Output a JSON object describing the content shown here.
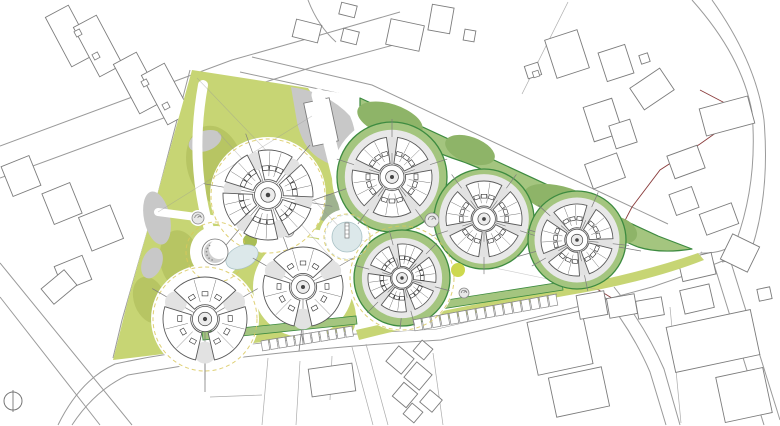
{
  "colors": {
    "bg": "#ffffff",
    "road": "#9a9a9a",
    "parcel": "#ababab",
    "ctx": "#7c7c7c",
    "red": "#8a3c3c",
    "olive": "#c7d574",
    "olive_dark": "#b7c563",
    "field": "#a4c57f",
    "field_dark": "#8eb468",
    "green_stroke": "#3d8b40",
    "grey": "#c8c8c8",
    "grey_green": "#9fb28f",
    "pond": "#dce8ea",
    "pond_stroke": "#a8c1c5",
    "yellow": "#d9c85c",
    "tree_fill": "#e2e2e2",
    "plaza_grey": "#e8e8e8",
    "tree_green": "#a8bd55",
    "tree_yellow": "#cdd94e",
    "bldg_stroke": "#5a5a5a"
  },
  "viewport": {
    "w": 780,
    "h": 426
  },
  "map": {
    "roads": [
      "M0,146 L232,60 L310,38 L400,12",
      "M0,178 L240,90 L316,66 L412,40",
      "M308,0 Q318,26 336,42",
      "M252,57 L372,85 L668,224",
      "M240,72 L360,98 L658,236",
      "M692,0 Q742,56 752,112 Q758,182 736,242 Q724,254 700,253",
      "M712,0 Q756,62 764,120 Q770,192 752,248 Q744,258 722,262",
      "M58,425 Q80,380 115,364 Q165,353 210,349 Q330,334 436,329 Q560,300 645,275 Q676,262 702,252",
      "M72,425 Q95,390 128,375 L218,360 Q335,346 441,340 Q565,311 652,287 Q700,271 744,252",
      "M712,258 L764,425",
      "M728,253 L780,420",
      "M600,291 Q632,330 650,372 L666,425",
      "M614,287 Q646,327 664,369 L680,425",
      "M0,263 L132,425",
      "M0,297 L100,425",
      "M190,70 L155,205 L122,320 L113,358",
      "M196,72 L160,206 L128,318"
    ],
    "parcel_lines": [
      "M268,358 L262,425",
      "M300,361 L296,425",
      "M332,356 L330,400",
      "M210,397 L262,395",
      "M568,2 L522,94",
      "M670,307 L681,423",
      "M352,347 L373,425",
      "M366,344 L388,425",
      "M433,353 L443,425"
    ],
    "red_boundary": [
      "M700,90 L744,113 L700,144 L660,170 L632,207 L608,253 L597,289",
      "M597,289 L643,317"
    ],
    "context_buildings": [
      [
        57,
        8,
        26,
        56,
        -28
      ],
      [
        85,
        18,
        26,
        56,
        -28
      ],
      [
        125,
        55,
        26,
        56,
        -28
      ],
      [
        153,
        66,
        26,
        56,
        -28
      ],
      [
        6,
        160,
        30,
        32,
        -22
      ],
      [
        47,
        187,
        30,
        33,
        -22
      ],
      [
        84,
        210,
        34,
        36,
        -22
      ],
      [
        58,
        260,
        30,
        26,
        -22
      ],
      [
        44,
        277,
        30,
        20,
        -40
      ],
      [
        294,
        22,
        26,
        18,
        14
      ],
      [
        340,
        4,
        16,
        12,
        14
      ],
      [
        342,
        30,
        16,
        13,
        14
      ],
      [
        388,
        22,
        34,
        26,
        12
      ],
      [
        430,
        6,
        22,
        26,
        10
      ],
      [
        464,
        30,
        11,
        11,
        10
      ],
      [
        550,
        34,
        34,
        40,
        -18
      ],
      [
        526,
        64,
        14,
        13,
        -18
      ],
      [
        602,
        48,
        28,
        30,
        -18
      ],
      [
        640,
        54,
        9,
        9,
        -18
      ],
      [
        634,
        76,
        36,
        26,
        -34
      ],
      [
        702,
        102,
        50,
        28,
        -15
      ],
      [
        588,
        102,
        30,
        36,
        -18
      ],
      [
        612,
        122,
        22,
        24,
        -18
      ],
      [
        588,
        158,
        34,
        26,
        -20
      ],
      [
        670,
        150,
        32,
        24,
        -20
      ],
      [
        672,
        190,
        24,
        22,
        -20
      ],
      [
        702,
        208,
        34,
        22,
        -20
      ],
      [
        726,
        238,
        28,
        30,
        -64
      ],
      [
        680,
        256,
        34,
        22,
        -13
      ],
      [
        682,
        287,
        30,
        24,
        -13
      ],
      [
        532,
        316,
        56,
        54,
        -12
      ],
      [
        552,
        372,
        54,
        40,
        -12
      ],
      [
        670,
        318,
        86,
        46,
        -12
      ],
      [
        720,
        372,
        48,
        46,
        -12
      ],
      [
        758,
        288,
        13,
        12,
        -12
      ],
      [
        578,
        293,
        28,
        24,
        -10
      ],
      [
        608,
        296,
        28,
        20,
        -10
      ],
      [
        637,
        299,
        26,
        18,
        -10
      ],
      [
        310,
        366,
        44,
        28,
        -8
      ],
      [
        390,
        350,
        20,
        20,
        40
      ],
      [
        408,
        366,
        20,
        20,
        40
      ],
      [
        396,
        386,
        18,
        18,
        40
      ],
      [
        416,
        343,
        14,
        14,
        40
      ],
      [
        423,
        393,
        16,
        16,
        40
      ],
      [
        406,
        406,
        14,
        14,
        40
      ]
    ],
    "window_marks": [
      [
        75,
        30,
        -28
      ],
      [
        93,
        53,
        -28
      ],
      [
        142,
        80,
        -28
      ],
      [
        163,
        103,
        -28
      ],
      [
        533,
        71,
        -18
      ]
    ],
    "site_outline": "M192,70 L360,96 L658,236 L702,252 L645,275 L560,300 L436,329 L330,334 L210,349 L113,360 L128,300 L160,185 Z",
    "olive_shapes": [
      "M192,70 L308,88 Q332,122 338,152 Q346,196 341,240 Q339,270 353,302 Q359,318 353,331 L205,349 L113,360 L128,300 L160,185 Z",
      "M356,330 Q460,306 562,288 Q645,272 698,253 L704,260 Q648,282 564,296 Q462,314 359,340 Z"
    ],
    "olive_patches": [
      [
        215,
        165,
        28,
        40,
        -15
      ],
      [
        180,
        260,
        20,
        30,
        -10
      ],
      [
        150,
        300,
        16,
        24,
        -20
      ],
      [
        330,
        300,
        20,
        14,
        -20
      ]
    ],
    "grey_blobs": [
      "M291,87 Q328,92 350,116 Q360,138 351,160 Q337,170 322,160 Q303,150 297,122 Z"
    ],
    "grey_ellipses": [
      [
        157,
        218,
        13,
        27,
        -12,
        "grey"
      ],
      [
        205,
        141,
        17,
        10,
        -20,
        "grey"
      ],
      [
        152,
        263,
        10,
        16,
        20,
        "grey"
      ],
      [
        330,
        208,
        18,
        14,
        0,
        "grey_green"
      ]
    ],
    "grey_building": [
      308,
      100,
      26,
      44,
      -12
    ],
    "white_paths": [
      {
        "d": "M203,85 Q188,168 213,242",
        "w": 10
      },
      {
        "d": "M318,95 Q332,152 347,212",
        "w": 13
      },
      {
        "d": "M158,212 Q250,224 325,235",
        "w": 8
      },
      {
        "d": "M213,262 Q208,285 207,300",
        "w": 9
      }
    ],
    "plazas": [
      [
        268,
        195,
        58
      ],
      [
        205,
        319,
        54
      ],
      [
        303,
        287,
        50
      ],
      [
        216,
        252,
        26
      ],
      [
        347,
        237,
        28
      ],
      [
        198,
        218,
        8
      ],
      [
        288,
        231,
        8
      ]
    ],
    "survey_lines": [
      "M197,78 L347,235",
      "M158,212 L312,116",
      "M347,237 L600,290",
      "M218,132 L335,262"
    ],
    "green_bands": [
      "M202,332 L356,316 L357,324 L203,340 Z",
      "M408,306 L562,282 L563,290 L409,314 Z"
    ],
    "white_rings": [
      [
        392,
        177,
        60
      ],
      [
        402,
        278,
        53
      ]
    ],
    "field_outline": "M360,98 L658,236 L692,249 Q660,254 638,247 Q612,237 598,222 Q578,205 552,198 Q522,192 502,180 Q478,166 452,158 Q424,148 403,137 Q378,124 360,111 Z",
    "field_patches": [
      [
        390,
        120,
        34,
        16,
        18
      ],
      [
        470,
        150,
        26,
        13,
        20
      ],
      [
        560,
        200,
        36,
        14,
        14
      ],
      [
        620,
        230,
        18,
        12,
        25
      ],
      [
        372,
        192,
        20,
        13,
        -10
      ],
      [
        600,
        248,
        14,
        18,
        -20
      ],
      [
        478,
        192,
        18,
        10,
        15
      ]
    ],
    "green_circles": [
      [
        392,
        177,
        55
      ],
      [
        484,
        219,
        50
      ],
      [
        402,
        278,
        48
      ],
      [
        577,
        240,
        49
      ]
    ],
    "parking_rows": [
      {
        "x1": 261,
        "y1": 341,
        "x2": 353,
        "y2": 326,
        "n": 11,
        "depth": 10
      },
      {
        "x1": 413,
        "y1": 320,
        "x2": 557,
        "y2": 294,
        "n": 16,
        "depth": 11
      }
    ],
    "trees": [
      {
        "x": 250,
        "y": 241,
        "r": 7,
        "c": "tree_green"
      },
      {
        "x": 458,
        "y": 270,
        "r": 7,
        "c": "tree_yellow"
      }
    ],
    "dashed_circles": [
      [
        268,
        196,
        57
      ],
      [
        216,
        252,
        30
      ],
      [
        205,
        319,
        52
      ],
      [
        347,
        237,
        23
      ],
      [
        402,
        278,
        52
      ]
    ],
    "ponds": {
      "central": {
        "x": 347,
        "y": 237,
        "r": 15
      },
      "west": {
        "x": 242,
        "y": 257,
        "rx": 17,
        "ry": 11,
        "rot": -25
      }
    },
    "crescent": {
      "x": 215,
      "y": 252,
      "r": 13
    },
    "spirals": [
      [
        198,
        218,
        6
      ],
      [
        288,
        231,
        6
      ],
      [
        432,
        220,
        7
      ],
      [
        464,
        293,
        5
      ]
    ],
    "stems": [
      [
        205,
        361,
        205,
        392
      ],
      [
        302,
        327,
        299,
        351
      ],
      [
        354,
        186,
        308,
        202
      ],
      [
        522,
        228,
        550,
        236
      ],
      [
        541,
        250,
        516,
        257
      ],
      [
        402,
        312,
        400,
        329
      ],
      [
        613,
        246,
        641,
        251
      ]
    ],
    "buildings": [
      {
        "x": 268,
        "y": 195,
        "r": 45,
        "wings": 6,
        "rot": 10,
        "pad": false
      },
      {
        "x": 205,
        "y": 319,
        "r": 42,
        "wings": 3,
        "rot": 90,
        "pad": false
      },
      {
        "x": 303,
        "y": 287,
        "r": 40,
        "wings": 3,
        "rot": 90,
        "pad": false
      },
      {
        "x": 392,
        "y": 177,
        "r": 40,
        "wings": 5,
        "rot": -18,
        "pad": true
      },
      {
        "x": 484,
        "y": 219,
        "r": 38,
        "wings": 5,
        "rot": 18,
        "pad": true
      },
      {
        "x": 402,
        "y": 278,
        "r": 34,
        "wings": 6,
        "rot": 15,
        "pad": true
      },
      {
        "x": 577,
        "y": 240,
        "r": 36,
        "wings": 5,
        "rot": 6,
        "pad": true
      }
    ],
    "north_arrow": {
      "x": 13,
      "y": 401,
      "r": 9
    }
  }
}
